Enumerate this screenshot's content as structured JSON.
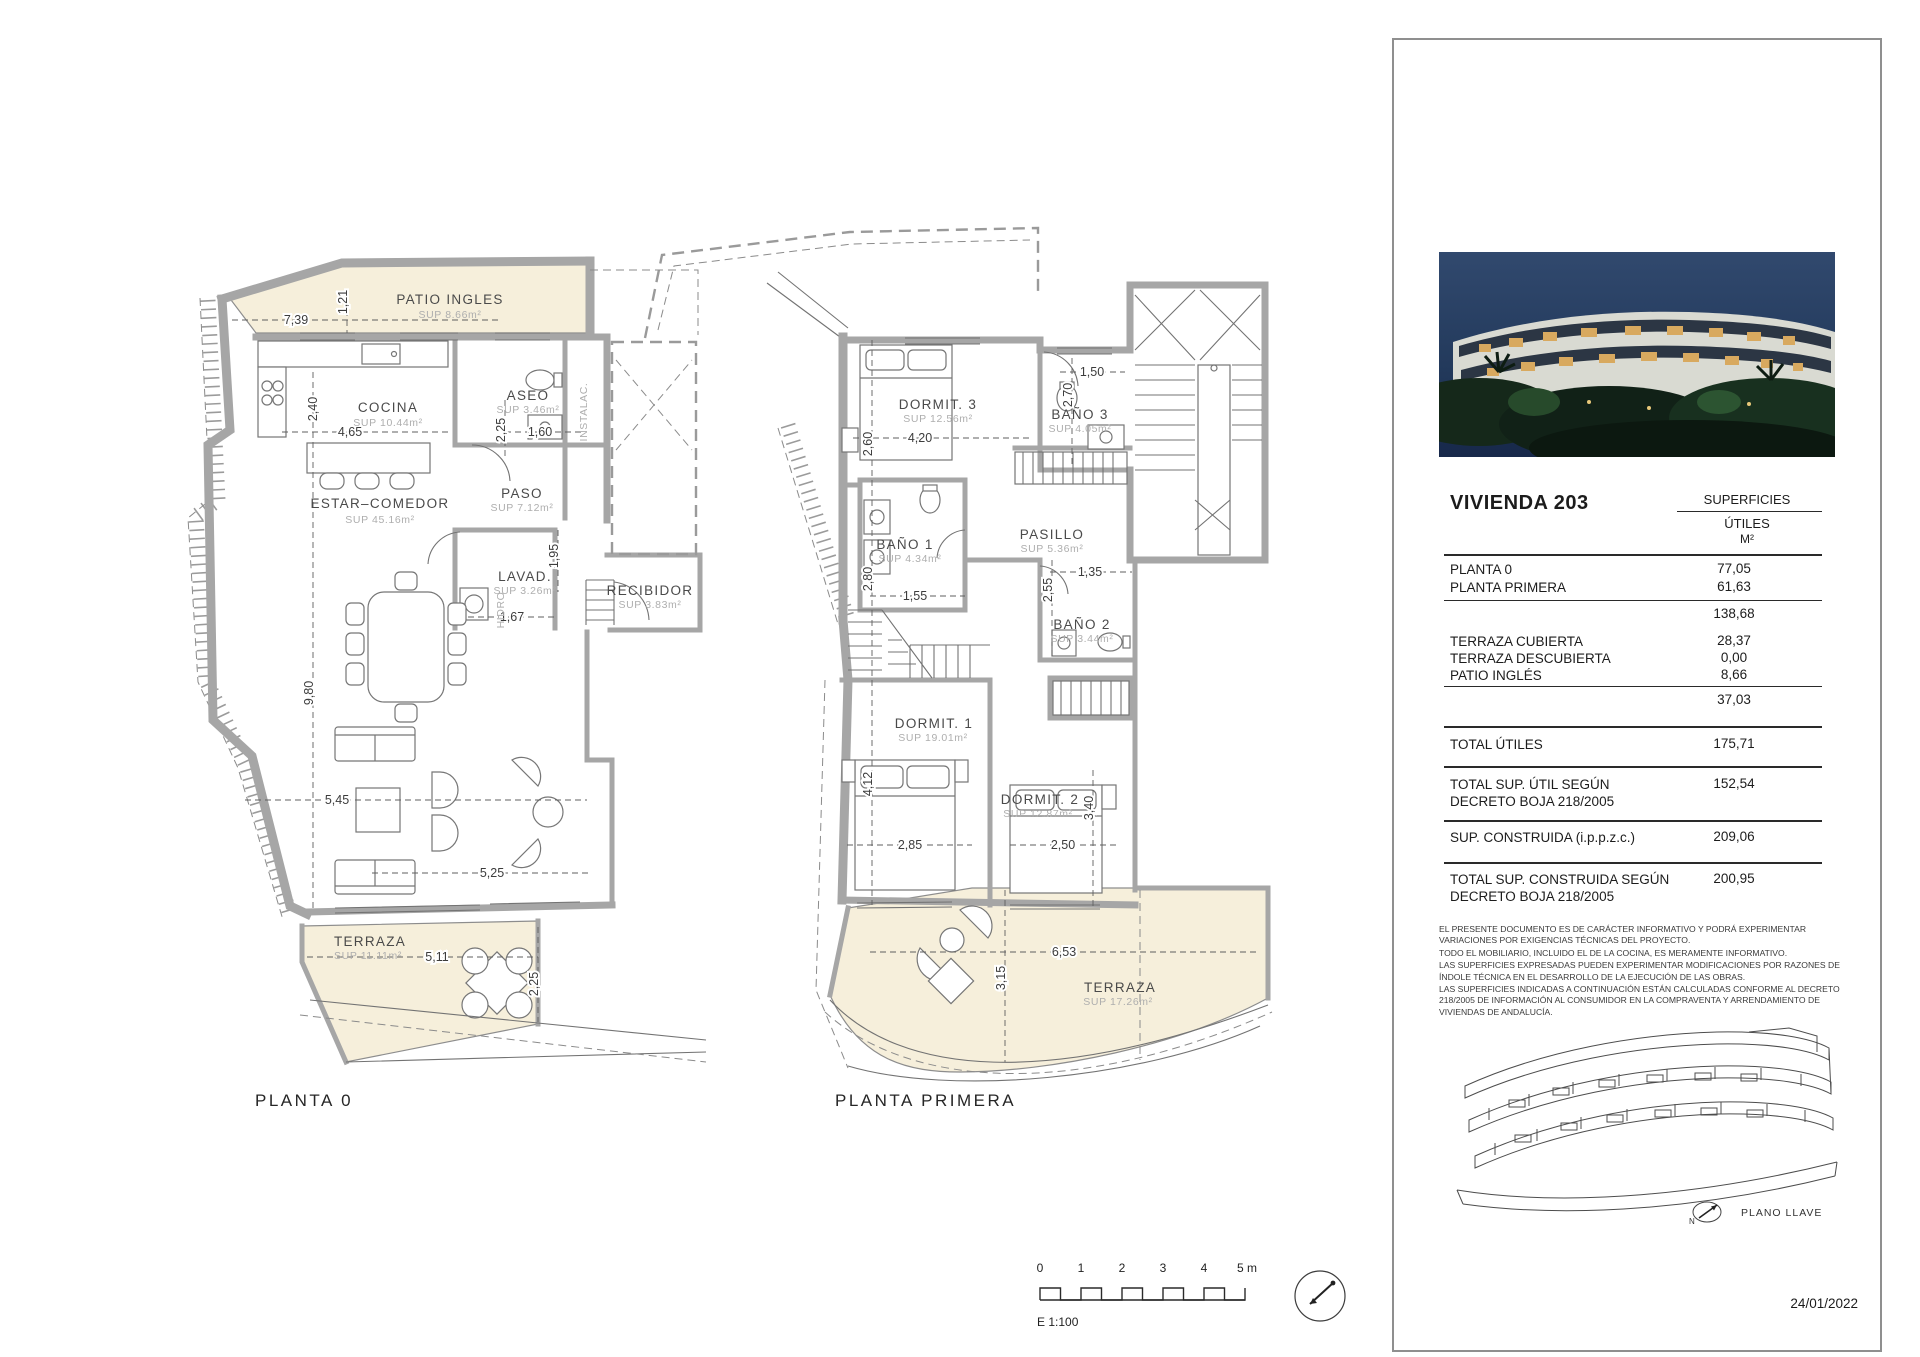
{
  "plans": [
    {
      "title": "PLANTA 0",
      "rooms": [
        {
          "name": "PATIO  INGLES",
          "sup": "SUP  8.66m²"
        },
        {
          "name": "COCINA",
          "sup": "SUP  10.44m²"
        },
        {
          "name": "ASEO",
          "sup": "SUP  3.46m²"
        },
        {
          "name": "INSTALAC.",
          "sup": ""
        },
        {
          "name": "PASO",
          "sup": "SUP  7.12m²"
        },
        {
          "name": "ESTAR–COMEDOR",
          "sup": "SUP  45.16m²"
        },
        {
          "name": "LAVAD.",
          "sup": "SUP  3.26m²"
        },
        {
          "name": "HIDRO",
          "sup": ""
        },
        {
          "name": "RECIBIDOR",
          "sup": "SUP  3.83m²"
        },
        {
          "name": "TERRAZA",
          "sup": "SUP  11.11m²"
        }
      ],
      "dims": [
        "7,39",
        "1,21",
        "2,40",
        "4,65",
        "2,25",
        "1,60",
        "1,95",
        "1,67",
        "9,80",
        "5,45",
        "5,25",
        "5,11",
        "2,25"
      ]
    },
    {
      "title": "PLANTA PRIMERA",
      "rooms": [
        {
          "name": "DORMIT.  3",
          "sup": "SUP  12.56m²"
        },
        {
          "name": "BAÑO  3",
          "sup": "SUP  4.05m²"
        },
        {
          "name": "BAÑO  1",
          "sup": "SUP  4.34m²"
        },
        {
          "name": "PASILLO",
          "sup": "SUP  5.36m²"
        },
        {
          "name": "BAÑO  2",
          "sup": "SUP  3.44m²"
        },
        {
          "name": "DORMIT.  1",
          "sup": "SUP  19.01m²"
        },
        {
          "name": "DORMIT.  2",
          "sup": "SUP  12.87m²"
        },
        {
          "name": "TERRAZA",
          "sup": "SUP  17.26m²"
        }
      ],
      "dims": [
        "1,50",
        "2,70",
        "4,20",
        "2,60",
        "2,80",
        "1,55",
        "1,35",
        "2,55",
        "4,12",
        "2,85",
        "2,50",
        "3,40",
        "6,53",
        "3,15"
      ]
    }
  ],
  "panel": {
    "unit_title": "VIVIENDA 203",
    "col_header": "SUPERFICIES",
    "col_sub1": "ÚTILES",
    "col_sub2": "M²",
    "rows": [
      {
        "label": "PLANTA 0",
        "value": "77,05"
      },
      {
        "label": "PLANTA PRIMERA",
        "value": "61,63"
      },
      {
        "label": "",
        "value": "138,68"
      },
      {
        "label": "TERRAZA CUBIERTA",
        "value": "28,37"
      },
      {
        "label": "TERRAZA DESCUBIERTA",
        "value": "0,00"
      },
      {
        "label": "PATIO INGLÉS",
        "value": "8,66"
      },
      {
        "label": "",
        "value": "37,03"
      },
      {
        "label": "TOTAL ÚTILES",
        "value": "175,71"
      },
      {
        "label": "TOTAL SUP. ÚTIL SEGÚN DECRETO BOJA 218/2005",
        "value": "152,54"
      },
      {
        "label": "SUP. CONSTRUIDA (i.p.p.z.c.)",
        "value": "209,06"
      },
      {
        "label": "TOTAL SUP. CONSTRUIDA SEGÚN DECRETO BOJA 218/2005",
        "value": "200,95"
      }
    ],
    "legal": [
      "EL PRESENTE DOCUMENTO ES DE CARÁCTER INFORMATIVO Y PODRÁ EXPERIMENTAR VARIACIONES POR EXIGENCIAS TÉCNICAS DEL PROYECTO.",
      "TODO EL MOBILIARIO, INCLUIDO EL DE LA COCINA, ES MERAMENTE INFORMATIVO.",
      "LAS SUPERFICIES EXPRESADAS PUEDEN EXPERIMENTAR MODIFICACIONES POR RAZONES DE ÍNDOLE TÉCNICA EN EL DESARROLLO DE LA EJECUCIÓN DE LAS OBRAS.",
      "LAS SUPERFICIES INDICADAS A CONTINUACIÓN ESTÁN CALCULADAS CONFORME AL DECRETO 218/2005 DE INFORMACIÓN AL CONSUMIDOR EN LA COMPRAVENTA Y ARRENDAMIENTO DE VIVIENDAS DE ANDALUCÍA."
    ],
    "keyplan_label": "PLANO LLAVE",
    "keyplan_north": "N",
    "date": "24/01/2022"
  },
  "scalebar": {
    "ticks": [
      "0",
      "1",
      "2",
      "3",
      "4",
      "5 m"
    ],
    "label": "E 1:100"
  }
}
